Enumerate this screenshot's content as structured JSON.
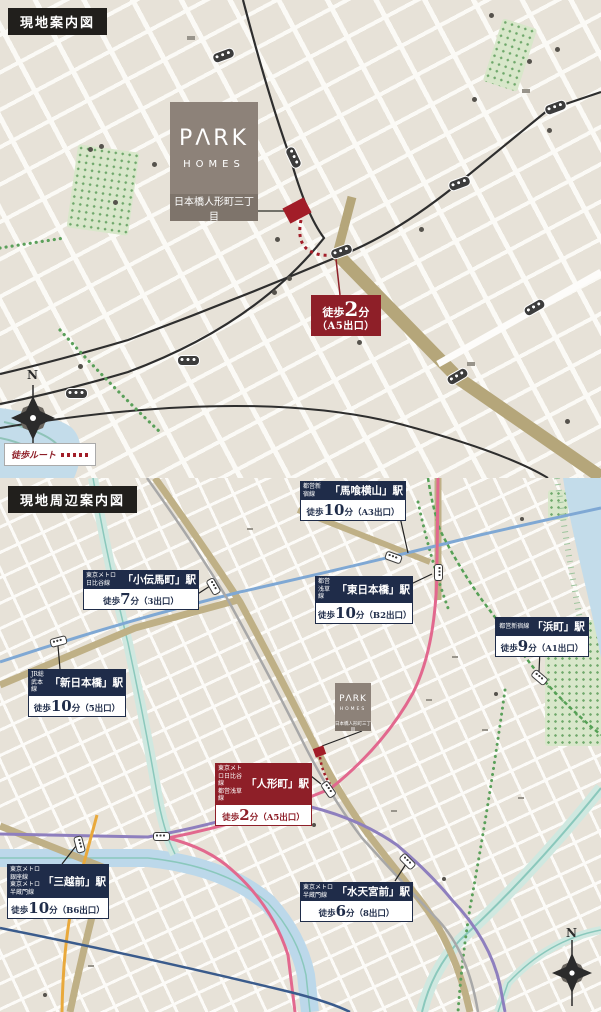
{
  "colors": {
    "navy": "#1f2c49",
    "red": "#8e1f28",
    "taupe": "#8d8279",
    "khaki": "#b5a67a",
    "river": "#c3dcea",
    "asakusa_pink": "#e2688e",
    "shinjuku_green": "#55a055",
    "sobu_blue": "#7fa8d4",
    "hanzomon_purple": "#8e7fbe",
    "ginza_orange": "#e9a93c",
    "hibiya_gray": "#a8a8a8",
    "tozai_navy": "#3a5b8c"
  },
  "top_map": {
    "tag": "現地案内図",
    "logo": {
      "brand": "PΛRK",
      "sub": "HOMES",
      "address": "日本橋人形町三丁目"
    },
    "badge": {
      "pre": "徒歩",
      "num": "2",
      "suf": "分",
      "line2": "（A5出口）"
    },
    "legend": {
      "label": "徒歩ルート"
    },
    "compass": "N",
    "boxes": [
      {
        "t": "堀留町",
        "x": 187,
        "y": 36
      },
      {
        "t": "久松警察署前",
        "x": 522,
        "y": 89
      },
      {
        "t": "甘酒横丁",
        "x": 467,
        "y": 362
      }
    ],
    "streets": [
      {
        "t": "東京メトロ日比谷線",
        "x": 236,
        "y": 8,
        "r": 64,
        "s": 13,
        "c": "#2b2b2b",
        "w2": 1
      },
      {
        "t": "都営浅草線",
        "x": 448,
        "y": 155,
        "r": -36,
        "s": 15,
        "c": "#2b2b2b",
        "w2": 1
      },
      {
        "t": "人形町",
        "x": 345,
        "y": 238,
        "r": -42,
        "s": 42,
        "c": "#1b1b1b",
        "w2": 1
      },
      {
        "t": "甘酒横丁",
        "x": 455,
        "y": 345,
        "r": -27,
        "s": 14,
        "c": "#8a8a8a"
      },
      {
        "t": "人形町通り",
        "x": 495,
        "y": 385,
        "r": 62,
        "s": 12,
        "c": "#8a8a8a"
      },
      {
        "t": "大門通り",
        "x": 560,
        "y": 333,
        "r": 72,
        "s": 11,
        "c": "#8a8a8a"
      },
      {
        "t": "末廣通り",
        "x": 512,
        "y": 193,
        "r": 36,
        "s": 11,
        "c": "#8a8a8a"
      }
    ],
    "pois": [
      {
        "t": "区立堀留町保育園",
        "x": 8,
        "y": 124
      },
      {
        "t": "堀留町区民館",
        "x": 10,
        "y": 142
      },
      {
        "t": "まいばすけっと",
        "x": 82,
        "y": 165
      },
      {
        "t": "堀留児童公園",
        "x": 48,
        "y": 208
      },
      {
        "t": "みずほ銀行",
        "x": 54,
        "y": 347
      },
      {
        "t": "日本橋小学校温水プール",
        "x": 172,
        "y": 385
      },
      {
        "t": "区立日本橋小学校",
        "x": 196,
        "y": 405
      },
      {
        "t": "区立日本橋幼稚園",
        "x": 228,
        "y": 426
      },
      {
        "t": "日本橋人形町",
        "x": 290,
        "y": 355
      },
      {
        "t": "郵便局",
        "x": 306,
        "y": 372
      },
      {
        "t": "モニカ人形町園",
        "x": 181,
        "y": 233
      },
      {
        "t": "サンマルクカフェ",
        "x": 191,
        "y": 266
      },
      {
        "t": "ファミリーマート",
        "x": 182,
        "y": 289
      },
      {
        "t": "スターバックス",
        "x": 332,
        "y": 126
      },
      {
        "t": "コーヒー",
        "x": 337,
        "y": 143
      },
      {
        "t": "エクセル",
        "x": 344,
        "y": 168
      },
      {
        "t": "シオール",
        "x": 344,
        "y": 183
      },
      {
        "t": "カフェ",
        "x": 344,
        "y": 198
      },
      {
        "t": "DAISO",
        "x": 300,
        "y": 235,
        "s": 12,
        "c": "#6f6a62"
      },
      {
        "t": "まちの",
        "x": 372,
        "y": 71
      },
      {
        "t": "てらこや保育園",
        "x": 329,
        "y": 87
      },
      {
        "t": "日本橋休日",
        "x": 423,
        "y": 8
      },
      {
        "t": "応急診療所",
        "x": 423,
        "y": 24
      },
      {
        "t": "久松警察署",
        "x": 523,
        "y": 31
      },
      {
        "t": "久松児童公園",
        "x": 445,
        "y": 52
      },
      {
        "t": "さくらさくみらい",
        "x": 432,
        "y": 75
      },
      {
        "t": "人形町",
        "x": 432,
        "y": 91
      },
      {
        "t": "日本橋消防署",
        "x": 514,
        "y": 137
      },
      {
        "t": "人形町出張所",
        "x": 514,
        "y": 153
      },
      {
        "t": "マルエツプチ",
        "x": 428,
        "y": 222
      },
      {
        "t": "区立人形町",
        "x": 519,
        "y": 400
      },
      {
        "t": "保育園",
        "x": 519,
        "y": 416
      }
    ]
  },
  "bottom_map": {
    "tag": "現地周辺案内図",
    "logo": {
      "brand": "PΛRK",
      "sub": "HOMES",
      "address": "日本橋人形町三丁目"
    },
    "compass": "N",
    "stations": [
      {
        "lines": [
          "都営新宿線"
        ],
        "name": "「馬喰横山」駅",
        "pre": "徒歩",
        "num": "10",
        "suf": "分（A3出口）",
        "x": 300,
        "y": 3,
        "w": 106
      },
      {
        "lines": [
          "東京メトロ日比谷線"
        ],
        "name": "「小伝馬町」駅",
        "pre": "徒歩",
        "num": "7",
        "suf": "分（3出口）",
        "x": 83,
        "y": 92,
        "w": 116
      },
      {
        "lines": [
          "都営浅草線"
        ],
        "name": "「東日本橋」駅",
        "pre": "徒歩",
        "num": "10",
        "suf": "分（B2出口）",
        "x": 315,
        "y": 98,
        "w": 98
      },
      {
        "lines": [
          "都営新宿線"
        ],
        "name": "「浜町」駅",
        "pre": "徒歩",
        "num": "9",
        "suf": "分（A1出口）",
        "x": 495,
        "y": 139,
        "w": 94
      },
      {
        "lines": [
          "JR総武本線"
        ],
        "name": "「新日本橋」駅",
        "pre": "徒歩",
        "num": "10",
        "suf": "分（5出口）",
        "x": 28,
        "y": 191,
        "w": 98
      },
      {
        "lines": [
          "東京メトロ日比谷線",
          "都営浅草線"
        ],
        "name": "「人形町」駅",
        "pre": "徒歩",
        "num": "2",
        "suf": "分（A5出口）",
        "x": 215,
        "y": 285,
        "w": 97,
        "theme": "red"
      },
      {
        "lines": [
          "東京メトロ銀座線",
          "東京メトロ半蔵門線"
        ],
        "name": "「三越前」駅",
        "pre": "徒歩",
        "num": "10",
        "suf": "分（B6出口）",
        "x": 7,
        "y": 386,
        "w": 102
      },
      {
        "lines": [
          "東京メトロ半蔵門線"
        ],
        "name": "「水天宮前」駅",
        "pre": "徒歩",
        "num": "6",
        "suf": "分（8出口）",
        "x": 300,
        "y": 404,
        "w": 113
      }
    ],
    "boxes": [
      {
        "t": "堀留町",
        "x": 247,
        "y": 50
      },
      {
        "t": "久松町",
        "x": 452,
        "y": 178
      },
      {
        "t": "久松警察署前",
        "x": 426,
        "y": 221
      },
      {
        "t": "浜町公園前",
        "x": 482,
        "y": 251
      },
      {
        "t": "浜町中ノ橋",
        "x": 518,
        "y": 319
      },
      {
        "t": "甘酒横丁",
        "x": 391,
        "y": 332
      },
      {
        "t": "日本橋",
        "x": 45,
        "y": 437
      },
      {
        "t": "日本橋一丁目",
        "x": 88,
        "y": 487
      }
    ],
    "streets": [
      {
        "t": "小伝馬町",
        "x": 209,
        "y": 74,
        "r": 60,
        "s": 13,
        "c": "#1f2c49",
        "w2": 1
      },
      {
        "t": "馬喰横山",
        "x": 352,
        "y": 42,
        "r": 58,
        "s": 12,
        "c": "#1f2c49",
        "w2": 1
      },
      {
        "t": "東日本橋",
        "x": 433,
        "y": 19,
        "v": 1,
        "s": 15,
        "c": "#1f2c49",
        "w2": 1
      },
      {
        "t": "新日本橋",
        "x": 36,
        "y": 172,
        "r": -21,
        "s": 15,
        "c": "#1f2c49",
        "w2": 1
      },
      {
        "t": "人形町",
        "x": 348,
        "y": 272,
        "r": -47,
        "s": 20,
        "c": "#1f2c49",
        "w2": 1
      },
      {
        "t": "三越前",
        "x": 24,
        "y": 384,
        "r": -24,
        "s": 17,
        "c": "#1f2c49",
        "w2": 1
      },
      {
        "t": "日本橋",
        "x": 24,
        "y": 448,
        "v": 1,
        "s": 16,
        "c": "#1f2c49",
        "w2": 1
      },
      {
        "t": "浜町",
        "x": 524,
        "y": 188,
        "r": -18,
        "s": 14,
        "c": "#1f2c49",
        "w2": 1
      },
      {
        "t": "水天宮通",
        "x": 428,
        "y": 404,
        "v": 1,
        "s": 11,
        "c": "#1f2c49",
        "w2": 1
      },
      {
        "t": "隅田川",
        "x": 574,
        "y": 36,
        "v": 1,
        "s": 10,
        "c": "#ffffff"
      },
      {
        "t": "日本橋川",
        "x": 100,
        "y": 370,
        "s": 8,
        "c": "#eef6fa"
      },
      {
        "t": "東京メトロ半蔵門線",
        "x": 90,
        "y": 355,
        "s": 8,
        "c": "#1f2c49"
      },
      {
        "t": "東京メトロ東西線",
        "x": 134,
        "y": 480,
        "r": 30,
        "s": 9,
        "c": "#1f2c49"
      },
      {
        "t": "都営新宿線",
        "x": 446,
        "y": 130,
        "r": 62,
        "s": 8,
        "c": "#4e9a4e"
      },
      {
        "t": "都営新宿線",
        "x": 549,
        "y": 50,
        "r": 62,
        "s": 8,
        "c": "#4e9a4e"
      },
      {
        "t": "都営浅草線",
        "x": 378,
        "y": 248,
        "r": -31,
        "s": 8,
        "c": "#1f2c49"
      },
      {
        "t": "JR総武本線",
        "x": 110,
        "y": 128,
        "r": -13,
        "s": 8,
        "c": "#6b93c4"
      },
      {
        "t": "東京メトロ日比谷線",
        "x": 281,
        "y": 136,
        "v": 1,
        "s": 8,
        "c": "#9a9a9a"
      },
      {
        "t": "清洲橋通り",
        "x": 518,
        "y": 276,
        "v": 1,
        "s": 8,
        "c": "#8f8b84"
      },
      {
        "t": "甘酒横丁",
        "x": 420,
        "y": 276,
        "v": 1,
        "s": 8,
        "c": "#8f8b84"
      }
    ],
    "pois": [
      {
        "t": "区立日本橋中学校",
        "x": 470,
        "y": 45,
        "s": 8
      },
      {
        "t": "日本橋税務署",
        "x": 300,
        "y": 160,
        "s": 8
      },
      {
        "t": "COREDO室町テラス",
        "x": 10,
        "y": 228,
        "s": 8
      },
      {
        "t": "COREDO室町",
        "x": 88,
        "y": 255,
        "s": 8
      },
      {
        "t": "三井記念美術館",
        "x": 8,
        "y": 277,
        "s": 8
      },
      {
        "t": "日本橋高島屋S.C.",
        "x": 46,
        "y": 510,
        "s": 8
      },
      {
        "t": "区立日本橋幼稚園",
        "x": 280,
        "y": 363,
        "s": 8
      },
      {
        "t": "日本橋人形町",
        "x": 308,
        "y": 326,
        "s": 7
      },
      {
        "t": "郵便局",
        "x": 318,
        "y": 335,
        "s": 7
      },
      {
        "t": "水天宮",
        "x": 444,
        "y": 396,
        "s": 8
      },
      {
        "t": "明治座",
        "x": 494,
        "y": 211,
        "s": 8
      },
      {
        "t": "浜町公園",
        "x": 554,
        "y": 186,
        "s": 8,
        "c": "#74936f"
      },
      {
        "t": "総合スポーツ",
        "x": 550,
        "y": 226,
        "s": 7
      },
      {
        "t": "センター",
        "x": 558,
        "y": 235,
        "s": 7
      }
    ]
  }
}
